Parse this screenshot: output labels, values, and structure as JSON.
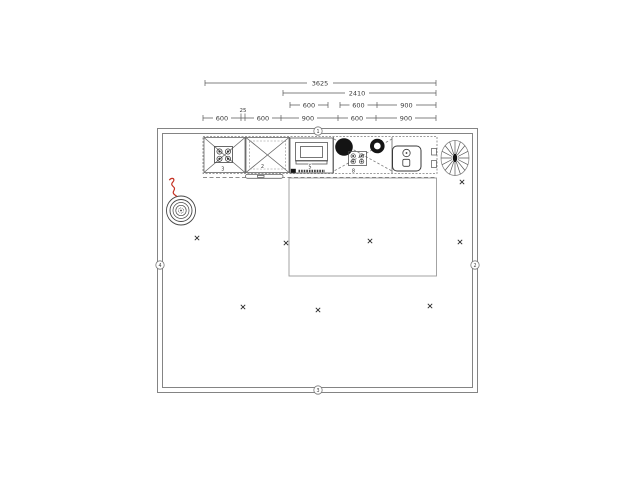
{
  "drawing": {
    "title": "kitchen-floor-plan",
    "dimension_rows": {
      "row1": {
        "label": "3625"
      },
      "row2": {
        "label": "2410"
      },
      "row3": {
        "seg1": "600",
        "seg2": "600",
        "seg3": "900"
      },
      "row4": {
        "seg1": "600",
        "seg2": "25",
        "seg3": "600",
        "seg4": "900",
        "seg5": "600",
        "seg6": "900"
      }
    },
    "wall_markers": {
      "top": "1",
      "right": "2",
      "bottom": "3",
      "left": "4"
    },
    "unit_labels": {
      "hob_cabinet": "3",
      "corner_cabinet": "2",
      "oven_unit": "5",
      "sink_hob_unit": "8"
    },
    "colors": {
      "background": "#ffffff",
      "line": "#555555",
      "wall": "#848484",
      "dark_fill": "#141414",
      "red_pipe": "#c43022"
    }
  }
}
